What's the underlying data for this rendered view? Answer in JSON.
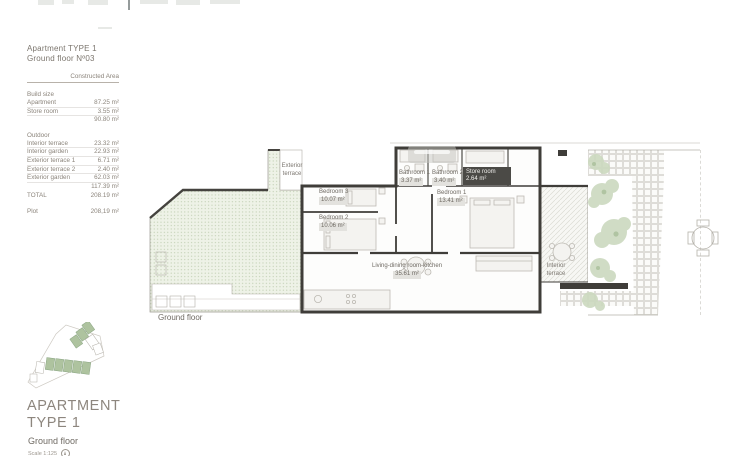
{
  "header": {
    "title_line1": "Apartment TYPE 1",
    "title_line2": "Ground floor Nº03"
  },
  "area_table": {
    "header": "Constructed Area",
    "build_section": "Build size",
    "rows_build": [
      {
        "label": "Apartment",
        "value": "87.25 m²"
      },
      {
        "label": "Store room",
        "value": "3.55 m²"
      }
    ],
    "build_subtotal": "90.80 m²",
    "outdoor_section": "Outdoor",
    "rows_outdoor": [
      {
        "label": "Interior terrace",
        "value": "23.32 m²"
      },
      {
        "label": "Interior garden",
        "value": "22.93 m²"
      },
      {
        "label": "Exterior terrace 1",
        "value": "6.71 m²"
      },
      {
        "label": "Exterior terrace 2",
        "value": "2.40 m²"
      },
      {
        "label": "Exterior garden",
        "value": "62.03 m²"
      }
    ],
    "outdoor_subtotal": "117.39 m²",
    "total_label": "TOTAL",
    "total_value": "208.19 m²",
    "plot_label": "Plot",
    "plot_value": "208,19 m²"
  },
  "plan": {
    "caption": "Ground floor",
    "rooms": {
      "bedroom3": {
        "name": "Bedroom 3",
        "area": "10.07 m²"
      },
      "bedroom2": {
        "name": "Bedroom 2",
        "area": "10.06 m²"
      },
      "bathroom1": {
        "name": "Bathroom 1",
        "area": "3.37 m²"
      },
      "bathroom2": {
        "name": "Bathroom 2",
        "area": "3.40 m²"
      },
      "store": {
        "name": "Store room",
        "area": "2.64 m²"
      },
      "bedroom1": {
        "name": "Bedroom 1",
        "area": "13.41 m²"
      },
      "living": {
        "name": "Living-dining room-kitchen",
        "area": "35.61 m²"
      }
    },
    "terraces": {
      "exterior": {
        "line1": "Exterior",
        "line2": "terrace"
      },
      "interior": {
        "line1": "Interior",
        "line2": "terrace"
      }
    }
  },
  "footer": {
    "line1": "APARTMENT",
    "line2": "TYPE 1",
    "subtitle": "Ground floor",
    "scale": "Scale 1:125"
  },
  "colors": {
    "wall": "#3f3d39",
    "garden_green": "#b4c5a4",
    "plant_green": "#ccd9bf",
    "chip_bg": "#e3e2de",
    "chip_dark": "#4b4a46",
    "text": "#8b847b"
  }
}
